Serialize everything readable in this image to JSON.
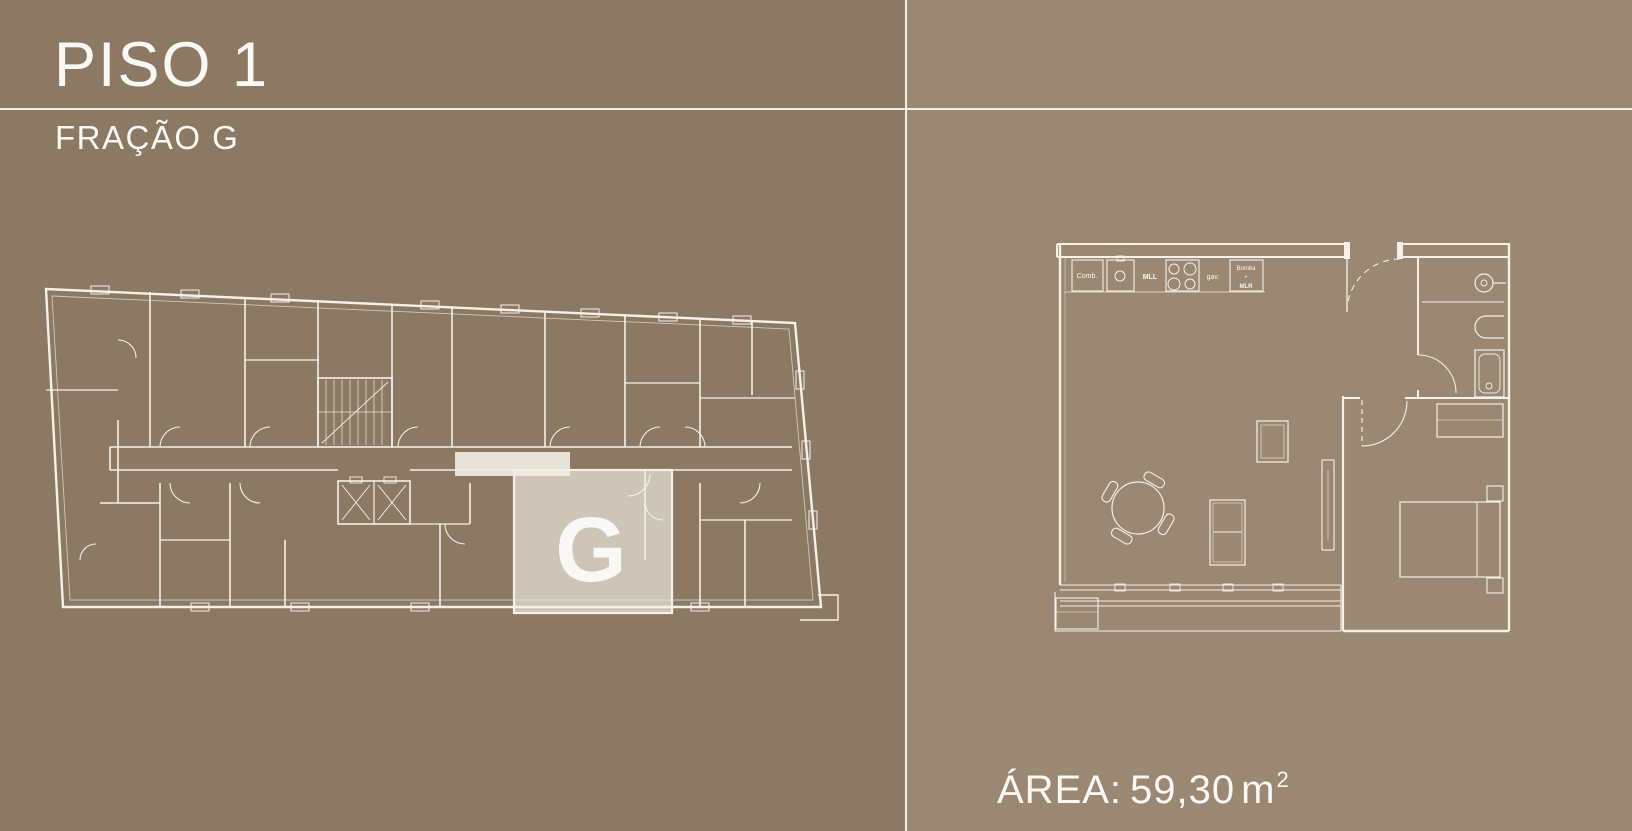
{
  "colors": {
    "bg_left": "#8c7963",
    "bg_right": "#9a8872",
    "divider_line": "#faf8f3",
    "plan_line": "#f5f1e9",
    "highlight_fill": "#cdc5b7",
    "highlight_letter": "#8d7a64"
  },
  "header": {
    "title": "PISO 1",
    "subtitle": "FRAÇÃO G"
  },
  "overview_plan": {
    "unit_label": "G"
  },
  "detail_plan": {
    "labels": {
      "comb": "Comb.",
      "mll": "MLL",
      "gav": "gav.",
      "bomba_line1": "Bomba",
      "bomba_line2": "+",
      "bomba_line3": "MLR"
    }
  },
  "area": {
    "label": "ÁREA:",
    "value": "59,30",
    "unit": "m",
    "exponent": "2"
  }
}
